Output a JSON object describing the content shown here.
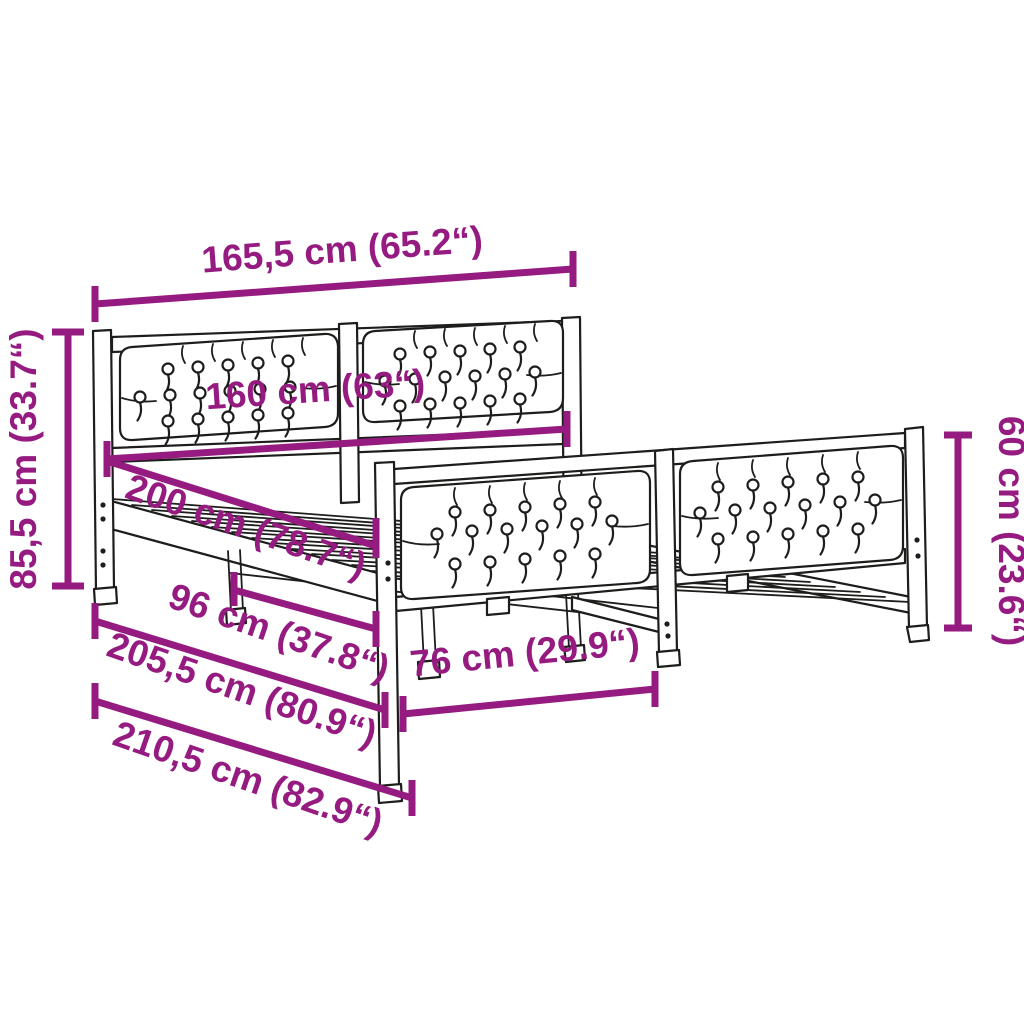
{
  "diagram": {
    "name": "bed-frame-dimension-diagram",
    "background": "#ffffff",
    "line_color": "#1d1d1b",
    "dimension_color": "#951b81",
    "dimensions": {
      "outer_width": "165,5 cm (65.2“)",
      "inner_width": "160 cm (63“)",
      "headboard_height": "85,5 cm (33.7“)",
      "inner_length": "200 cm (78.7“)",
      "support_length": "96 cm (37.8“)",
      "outer_length_1": "205,5 cm (80.9“)",
      "outer_length_2": "210,5 cm (82.9“)",
      "footboard_width": "76 cm (29.9“)",
      "footboard_height": "60 cm (23.6“)"
    }
  }
}
